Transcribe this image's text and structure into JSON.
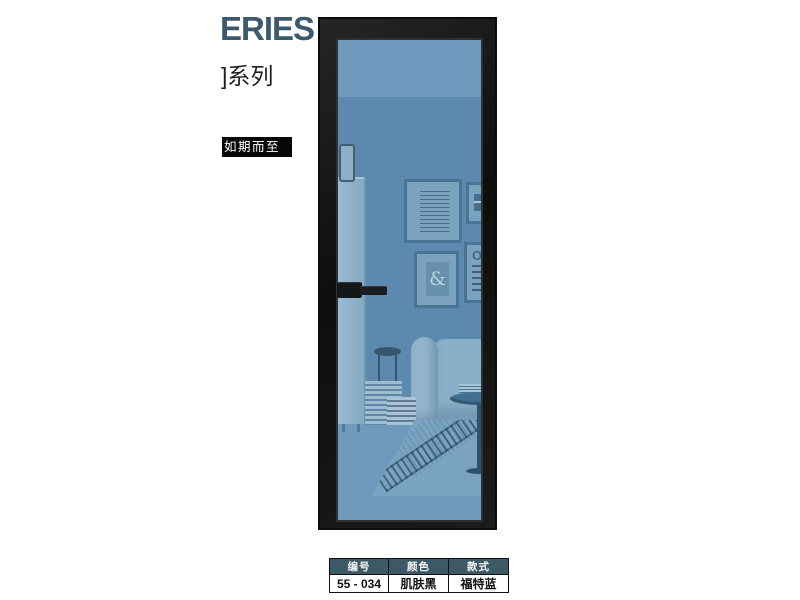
{
  "header": {
    "series_title": "ERIES",
    "series_subtitle": "]系列",
    "tagline": "如期而至"
  },
  "door": {
    "scene": {
      "ampersand": "&",
      "eyechart_letter": "O"
    }
  },
  "spec_table": {
    "columns": [
      {
        "label": "编号",
        "value": "55 - 034"
      },
      {
        "label": "颜色",
        "value": "肌肤黑"
      },
      {
        "label": "款式",
        "value": "福特蓝"
      }
    ]
  },
  "colors": {
    "series_title_text": "#3c5a6e",
    "tagline_bg": "#070707",
    "tagline_text": "#ffffff",
    "door_frame": "#1a1a1a",
    "glass_ceiling": "#6f99bd",
    "glass_wall": "#5e89ae",
    "glass_floor": "#6f9abc",
    "table_header_bg": "#3d5965",
    "table_header_text": "#f4f4f4",
    "table_value_text": "#101010"
  }
}
